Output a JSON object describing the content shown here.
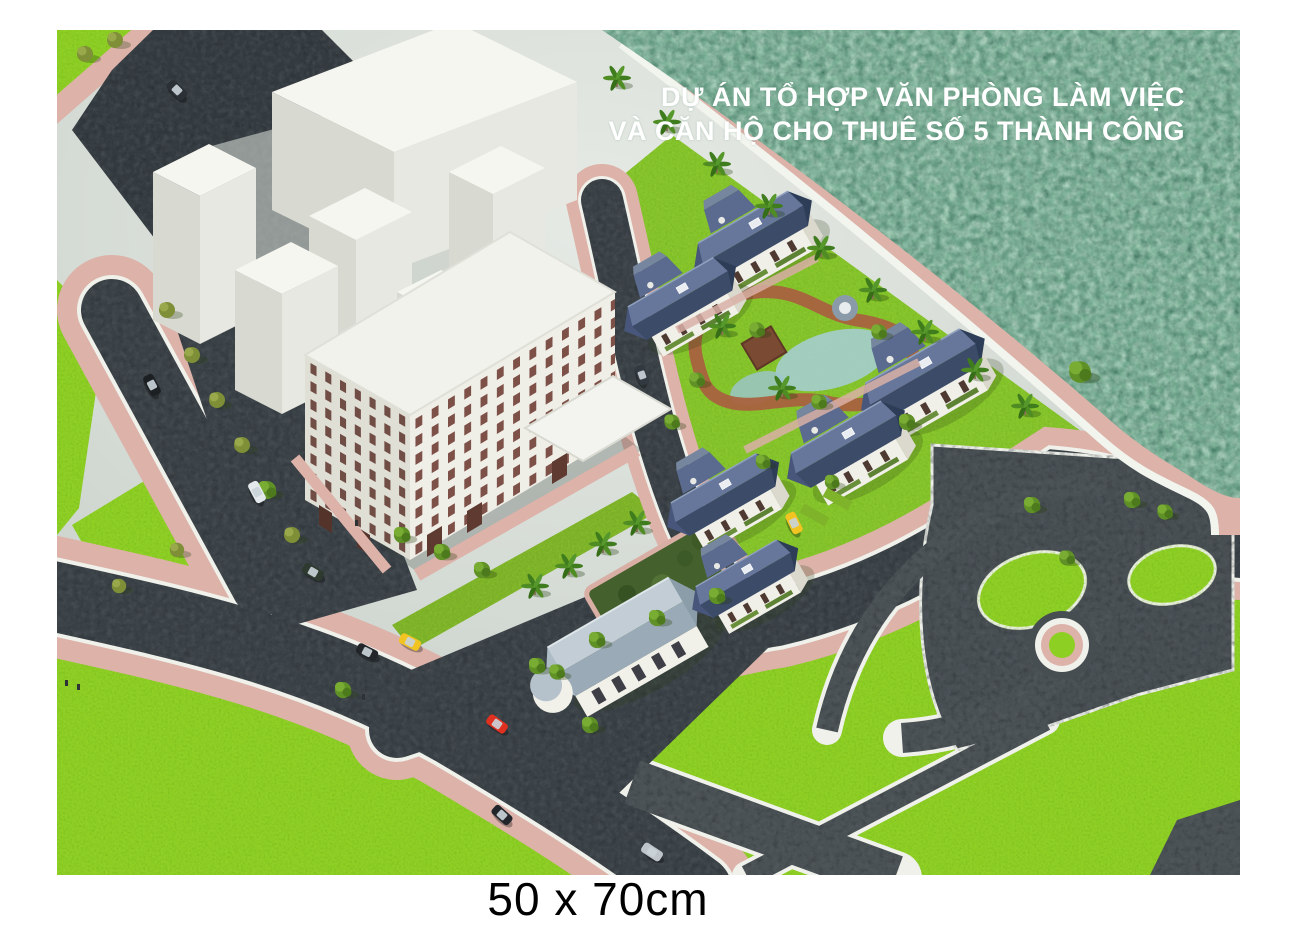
{
  "poster": {
    "title_line1": "DỰ ÁN TỔ HỢP VĂN PHÒNG LÀM VIỆC",
    "title_line2": "VÀ CĂN HỘ CHO THUÊ SỐ 5 THÀNH CÔNG",
    "size_caption": "50 x 70cm",
    "title_color": "#ffffff",
    "caption_color": "#000000",
    "background_color": "#ffffff"
  },
  "scene_palette": {
    "water": "#7CB297",
    "lawn": "#8ECF24",
    "road": "#3A4146",
    "park_path": "#4A5154",
    "sidewalk_pink": "#DCB2A9",
    "curb_white": "#EFF1EA",
    "building_white": "#F2F3EE",
    "building_shade": "#DDDCD3",
    "office_window_brown": "#6E3B32",
    "villa_roof_dark": "#3C4B68",
    "villa_roof_light": "#66779B",
    "clubhouse_roof": "#AFBEC8",
    "garden_path_terracotta": "#A9623F",
    "pond_blue": "#A7CFD8",
    "tree_green": "#5F9126",
    "palm_green": "#3F7C1E",
    "taxi_yellow": "#F2C422",
    "car_red": "#E0301F",
    "backdrop_gray": "#D3D8D3"
  }
}
